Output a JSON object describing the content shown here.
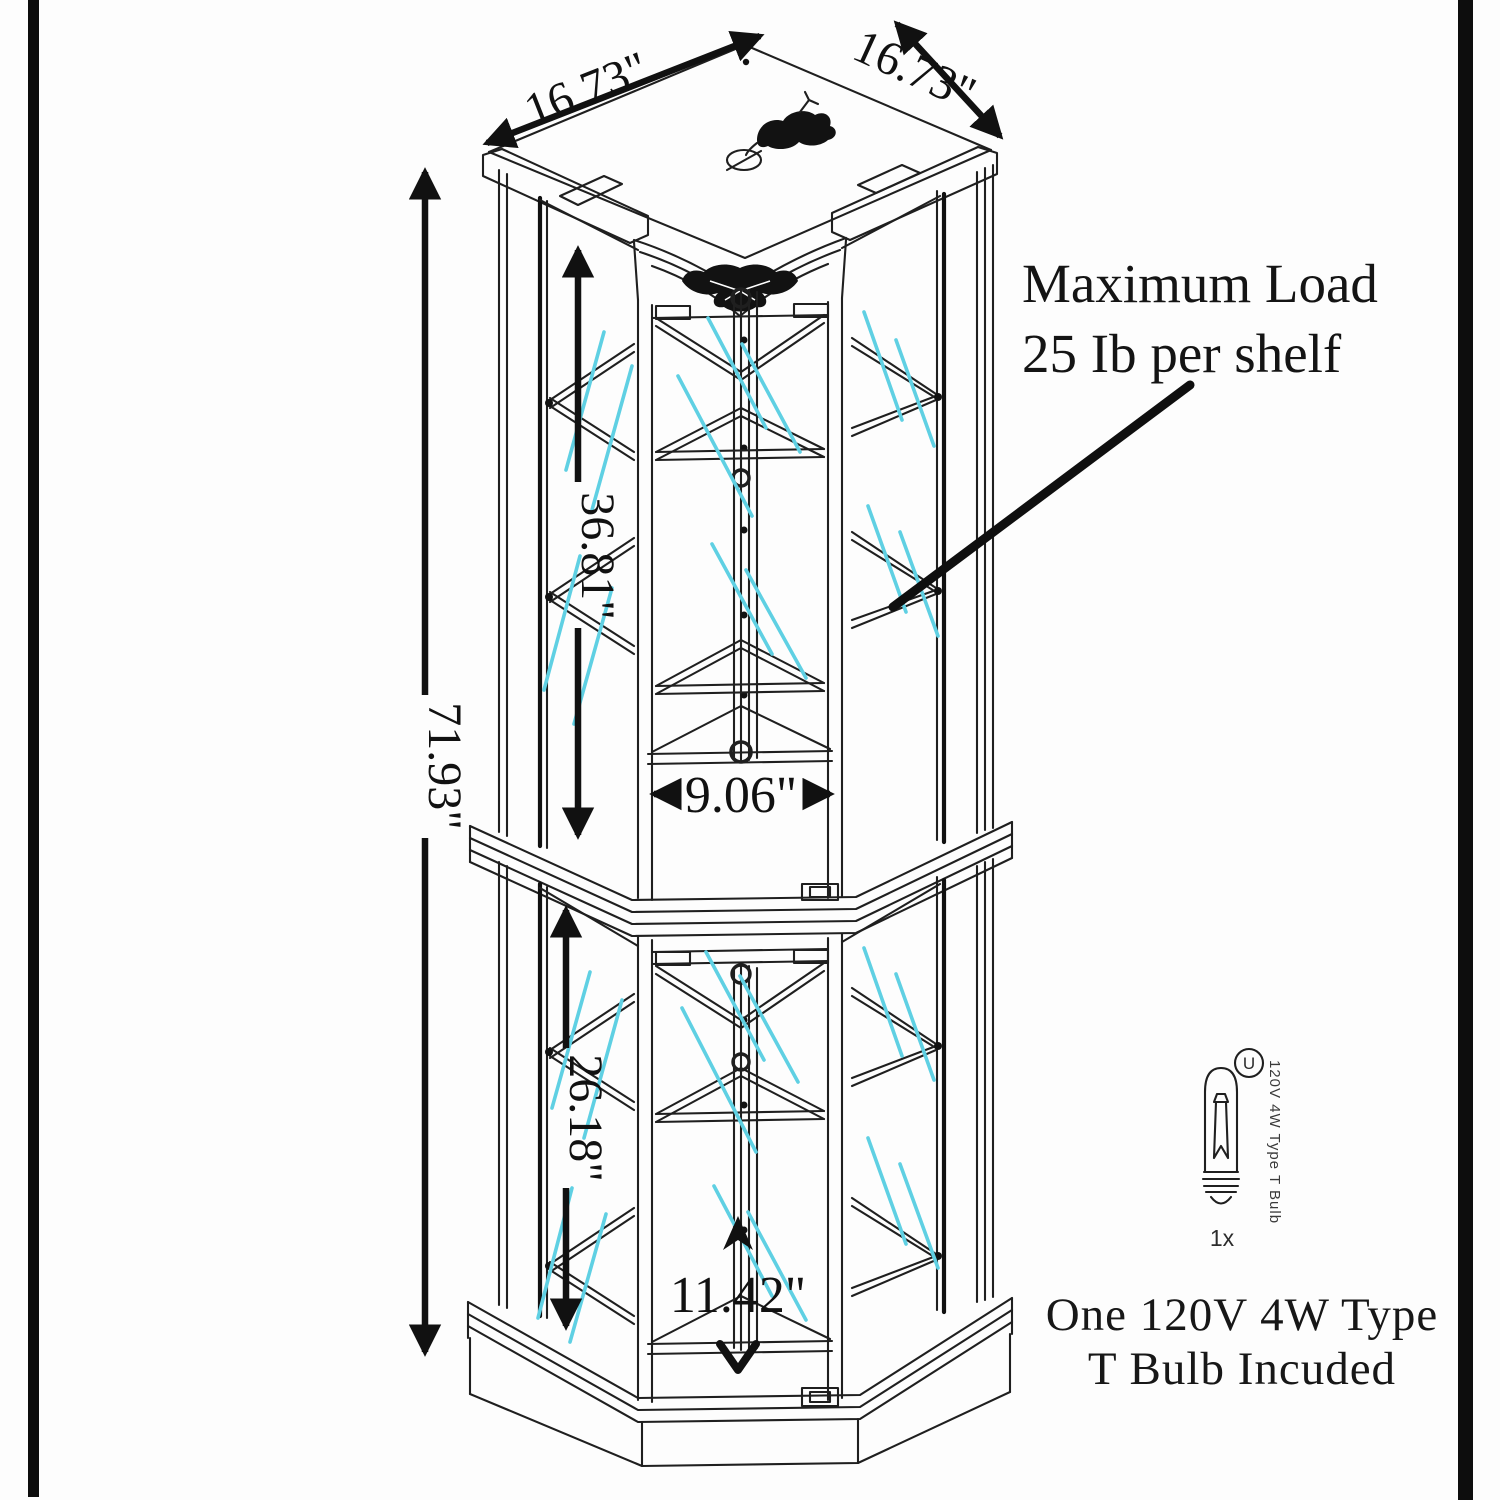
{
  "figure": {
    "type": "furniture-dimension-diagram",
    "subject": "corner curio display cabinet line drawing"
  },
  "annotations": {
    "top_left_width": "16.73\"",
    "top_right_width": "16.73\"",
    "overall_height": "71.93\"",
    "upper_interior_height": "36.81\"",
    "lower_interior_height": "26.18\"",
    "upper_shelf_width": "9.06\"",
    "lower_shelf_width": "11.42\"",
    "max_load_line1": "Maximum Load",
    "max_load_line2": "25 Ib per shelf"
  },
  "bulb": {
    "certification_mark": "U",
    "spec_label": "120V 4W Type T Bulb",
    "quantity": "1x",
    "note_line1": "One 120V 4W Type",
    "note_line2": "T Bulb Incuded"
  },
  "colors": {
    "line": "#1f1f1f",
    "dimension": "#111111",
    "glass_shine": "#5fd0e3",
    "background": "#fdfdfd",
    "border": "#0d0d0d"
  }
}
